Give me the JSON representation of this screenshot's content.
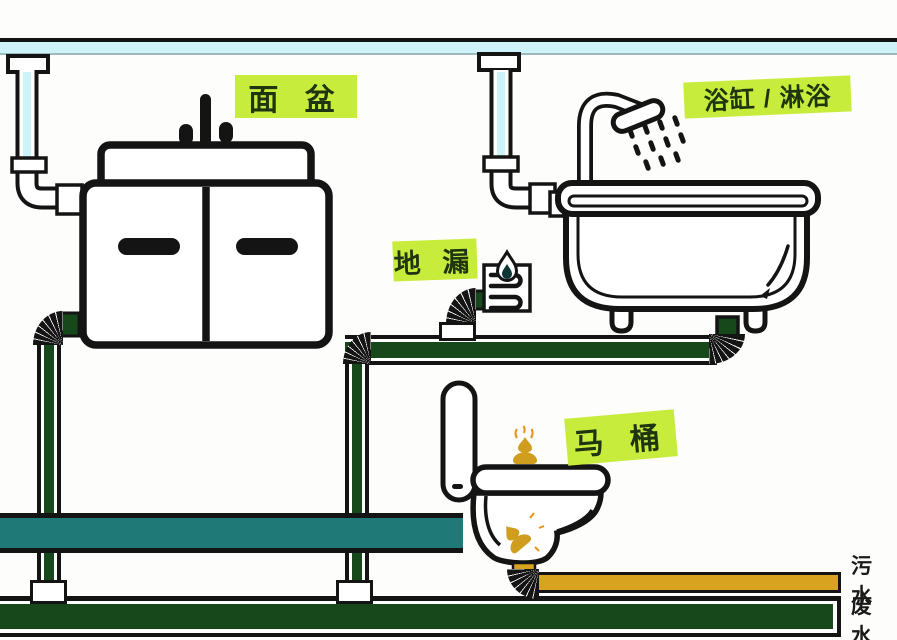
{
  "labels": {
    "basin": "面 盆",
    "bathtub_shower": "浴缸 / 淋浴",
    "floor_drain": "地 漏",
    "toilet": "马 桶"
  },
  "legend": {
    "sewage": "污水",
    "wastewater": "废水"
  },
  "colors": {
    "label_bg": "#c8ec3c",
    "label_text": "#1e350f",
    "drain_pipe_green": "#17481c",
    "toilet_supply_teal": "#1f7977",
    "sewage_yellow": "#d8a41f",
    "vent_pipe_blue": "#cdf2f7",
    "outline_black": "#141414",
    "poop_gold": "#d09d1e",
    "flame_orange": "#e8931f"
  },
  "icons": {
    "shower_head": "shower-head-icon",
    "water_drop": "water-drop-icon",
    "drain_grate": "drain-grate-icon",
    "faucet": "faucet-icon",
    "poop": "poop-icon",
    "flame": "flame-icon"
  }
}
